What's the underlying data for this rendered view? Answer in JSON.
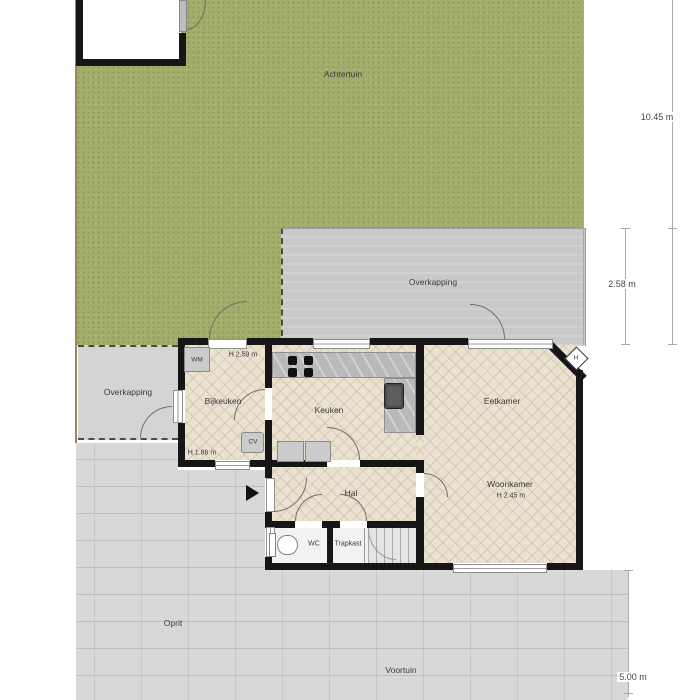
{
  "areas": {
    "achtertuin": {
      "label": "Achtertuin"
    },
    "overkapping_center": {
      "label": "Overkapping"
    },
    "overkapping_left": {
      "label": "Overkapping"
    },
    "oprit": {
      "label": "Oprit"
    },
    "voortuin": {
      "label": "Voortuin"
    }
  },
  "rooms": {
    "bijkeuken": {
      "label": "Bijkeuken",
      "height_top": "H 2.59 m",
      "height_bottom": "H 1.86 m"
    },
    "keuken": {
      "label": "Keuken"
    },
    "eetkamer": {
      "label": "Eetkamer"
    },
    "woonkamer": {
      "label": "Woonkamer",
      "height": "H 2.45 m"
    },
    "hal": {
      "label": "Hal"
    },
    "wc": {
      "label": "WC"
    },
    "trapkast": {
      "label": "Trapkast"
    }
  },
  "fixtures": {
    "wasmachine": "WM",
    "cv_ketel": "CV",
    "h_marker": "H"
  },
  "dimensions": {
    "achtertuin_depth": "10.45 m",
    "overkapping_depth": "2.58 m",
    "voortuin_depth": "5.00 m"
  },
  "colors": {
    "grass": "#a4ac6c",
    "canopy": "#c9c9c9",
    "paving": "#d8d8d8",
    "floor": "#eae1d0",
    "wall": "#161616"
  }
}
